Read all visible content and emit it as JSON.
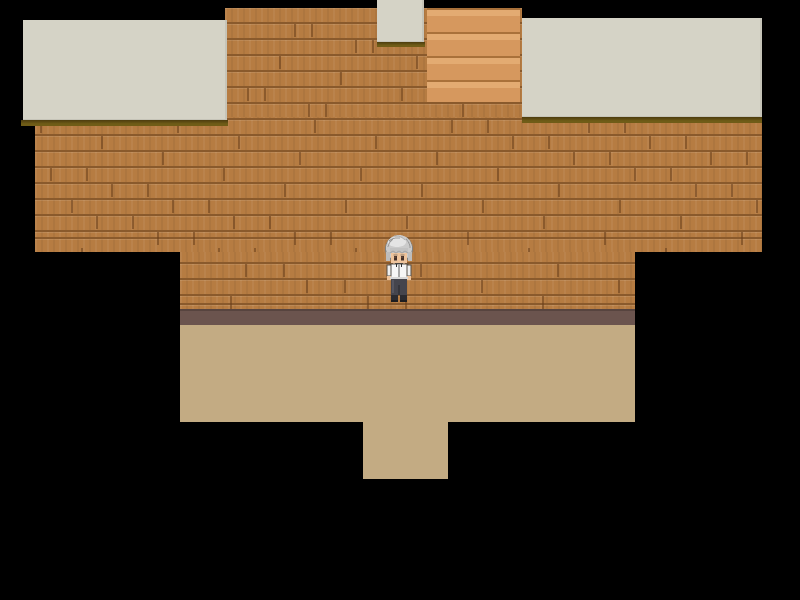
{
  "scene": {
    "type": "rpg-topdown-interior-room",
    "viewport": {
      "width": 800,
      "height": 600
    },
    "palette": {
      "bg": "#000000",
      "wood_plank": "#b67c42",
      "wood_line": "#8a5a2c",
      "counter": "#d5d3c6",
      "counter_shadow": "#6f5c17",
      "counter_shadow_dark": "#4c3c0e",
      "stairs_mid": "#d6985e",
      "stairs_light": "#e3ab72",
      "stairs_line": "#a9713a",
      "trim": "#6b544e",
      "floor": "#c3ab83",
      "hair": "#cbcbcb",
      "hair_shine": "#e4e4e4",
      "hair_shade": "#9a9a9a",
      "skin": "#efc49c",
      "shirt": "#f6f6f6",
      "pants": "#45454d",
      "shoes": "#2b2b30"
    },
    "regions": [
      {
        "name": "wall-top-column",
        "role": "wood-wall",
        "x": 225,
        "y": 8,
        "w": 297,
        "h": 112
      },
      {
        "name": "wall-upper",
        "role": "wood-wall",
        "x": 35,
        "y": 117,
        "w": 727,
        "h": 135
      },
      {
        "name": "wall-middle",
        "role": "wood-wall",
        "x": 180,
        "y": 252,
        "w": 455,
        "h": 57
      },
      {
        "name": "staircase",
        "role": "stairs",
        "x": 427,
        "y": 8,
        "w": 93,
        "h": 94
      },
      {
        "name": "wall-base-trim",
        "role": "trim",
        "x": 180,
        "y": 309,
        "w": 455,
        "h": 16
      },
      {
        "name": "floor-main",
        "role": "floor",
        "x": 180,
        "y": 325,
        "w": 455,
        "h": 97
      },
      {
        "name": "floor-doorway",
        "role": "floor",
        "x": 363,
        "y": 422,
        "w": 85,
        "h": 57
      },
      {
        "name": "counter-left",
        "role": "counter",
        "x": 23,
        "y": 20,
        "w": 204,
        "h": 100
      },
      {
        "name": "counter-left-shadow",
        "role": "shadow",
        "x": 21,
        "y": 120,
        "w": 207,
        "h": 6
      },
      {
        "name": "counter-right",
        "role": "counter",
        "x": 522,
        "y": 18,
        "w": 240,
        "h": 99
      },
      {
        "name": "counter-right-shadow",
        "role": "shadow",
        "x": 522,
        "y": 117,
        "w": 240,
        "h": 6
      },
      {
        "name": "counter-small",
        "role": "counter",
        "x": 377,
        "y": 0,
        "w": 47,
        "h": 42
      },
      {
        "name": "counter-small-shadow",
        "role": "shadow",
        "x": 377,
        "y": 42,
        "w": 48,
        "h": 5
      }
    ],
    "character": {
      "name": "player",
      "facing": "down",
      "hair": "silver-grey",
      "outfit": "white shirt, dark trousers",
      "x": 384,
      "y": 233,
      "w": 30,
      "h": 71
    }
  }
}
